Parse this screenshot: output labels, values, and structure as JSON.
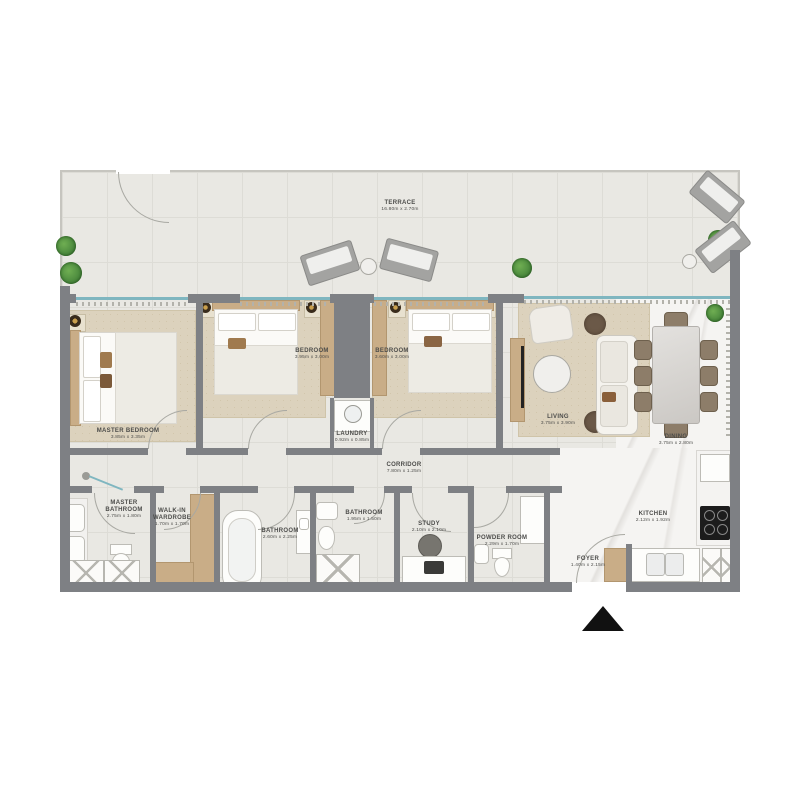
{
  "plan": {
    "rooms": {
      "terrace": {
        "name": "TERRACE",
        "dims": "16.80m x 2.70m"
      },
      "master_bedroom": {
        "name": "MASTER BEDROOM",
        "dims": "3.85m x 3.35m"
      },
      "bedroom1": {
        "name": "BEDROOM",
        "dims": "3.95m x 3.00m"
      },
      "bedroom2": {
        "name": "BEDROOM",
        "dims": "3.60m x 3.00m"
      },
      "laundry": {
        "name": "LAUNDRY",
        "dims": "0.92m x 0.85m"
      },
      "corridor": {
        "name": "CORRIDOR",
        "dims": "7.80m x 1.25m"
      },
      "living": {
        "name": "LIVING",
        "dims": "3.75m x 3.90m"
      },
      "dining": {
        "name": "DINING",
        "dims": "3.75m x 2.80m"
      },
      "master_bathroom": {
        "name": "MASTER BATHROOM",
        "dims": "2.75m x 1.80m"
      },
      "walk_in_wardrobe": {
        "name": "WALK-IN WARDROBE",
        "dims": "1.70m x 1.70m"
      },
      "bathroom1": {
        "name": "BATHROOM",
        "dims": "2.60m x 2.25m"
      },
      "bathroom2": {
        "name": "BATHROOM",
        "dims": "1.95m x 1.50m"
      },
      "study": {
        "name": "STUDY",
        "dims": "2.10m x 2.10m"
      },
      "powder_room": {
        "name": "POWDER ROOM",
        "dims": "2.29m x 1.70m"
      },
      "foyer": {
        "name": "FOYER",
        "dims": "1.40m x 2.15m"
      },
      "kitchen": {
        "name": "KITCHEN",
        "dims": "2.12m x 1.92m"
      }
    },
    "colors": {
      "wall": "#7e8084",
      "tile": "#e9e8e3",
      "tile_line": "#dddcd6",
      "marble": "#f5f4f2",
      "wood": "#c9ad87",
      "rug": "#dcd2bd",
      "plant": "#4c8a3e",
      "window": "#7fb6c0",
      "dark": "#6b5948",
      "chair": "#8d7d69",
      "label": "#4c4c4a",
      "stove": "#1c1c1c"
    }
  }
}
